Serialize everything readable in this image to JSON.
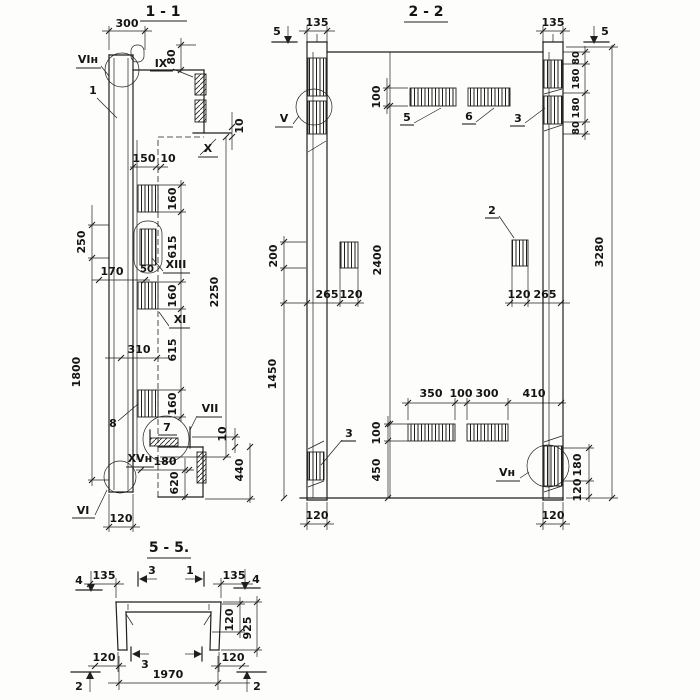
{
  "s11": {
    "title": "1 - 1",
    "d300": "300",
    "d80": "80",
    "d10_step": "10",
    "d150": "150",
    "d10_rib": "10",
    "d160_1": "160",
    "d615_1": "615",
    "d160_2": "160",
    "d615_2": "615",
    "d160_3": "160",
    "d2250": "2250",
    "d250": "250",
    "d170": "170",
    "d50": "50",
    "d310": "310",
    "d1800": "1800",
    "d180": "180",
    "d620": "620",
    "d440": "440",
    "d10_flange": "10",
    "d120": "120",
    "l_vin": "VIн",
    "l_ix": "IX",
    "l_x": "X",
    "l_xiii": "XIII",
    "l_xi": "XI",
    "l_vii": "VII",
    "l_xvn": "XVн",
    "l_vi": "VI",
    "c1": "1",
    "c7": "7",
    "c8": "8"
  },
  "s22": {
    "title": "2 - 2",
    "m5l": "5",
    "m5r": "5",
    "d135l": "135",
    "d135r": "135",
    "d80t": "80",
    "d180t": "180",
    "d180b": "180",
    "d80b": "80",
    "d3280": "3280",
    "d100t": "100",
    "d200": "200",
    "d1450": "1450",
    "d2400": "2400",
    "d265l": "265",
    "d120l": "120",
    "d120r": "120",
    "d265r": "265",
    "d350": "350",
    "d100m": "100",
    "d300": "300",
    "d410": "410",
    "d100b": "100",
    "d450": "450",
    "d180r": "180",
    "d120rb": "120",
    "d120bl": "120",
    "d120br": "120",
    "c5": "5",
    "c6": "6",
    "c3t": "3",
    "c2": "2",
    "c3b": "3",
    "l_v": "V",
    "l_vn": "Vн"
  },
  "s55": {
    "title": "5 - 5.",
    "d135l": "135",
    "d135r": "135",
    "d120t": "120",
    "d925": "925",
    "d120bl": "120",
    "d120br": "120",
    "d1970": "1970",
    "m4l": "4",
    "m4r": "4",
    "m3t": "3",
    "m1t": "1",
    "m2l": "2",
    "m2r": "2",
    "m3b": "3"
  }
}
